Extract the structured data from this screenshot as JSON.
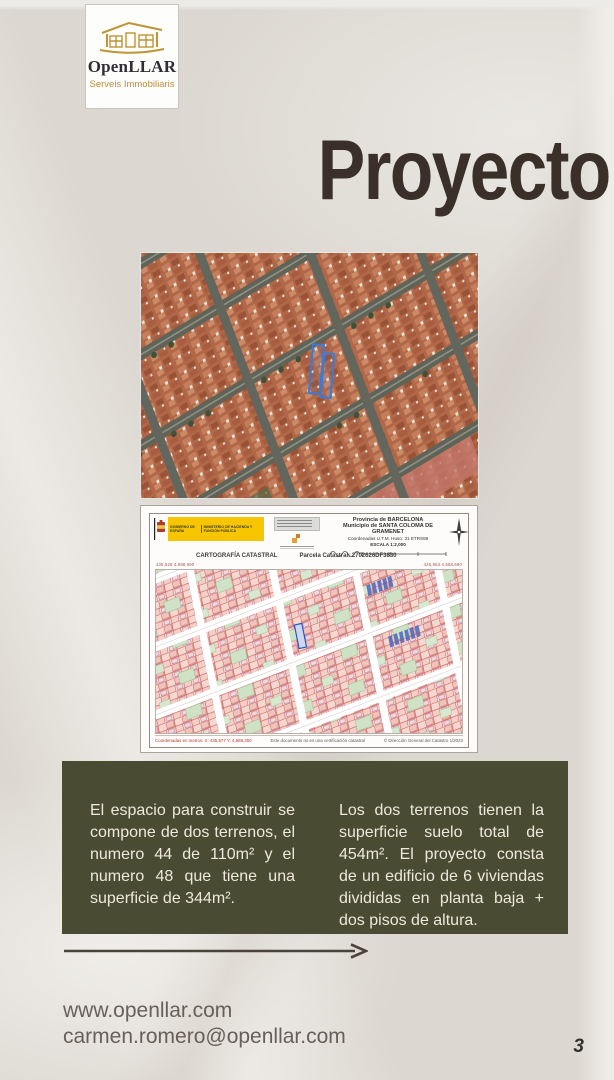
{
  "title": "Proyecto",
  "logo": {
    "name": "OpenLLAR",
    "tagline": "Serveis Immobiliaris",
    "house_icon": "gold-house-outline"
  },
  "colors": {
    "background": "#dcd8d1",
    "title_brown": "#3a3029",
    "accent_olive": "#494b32",
    "logo_gold": "#bf9434",
    "parcel_highlight_blue": "#3b7bd8",
    "map_parcel_pink": "#f6d8d2",
    "map_line_red": "#c4524a"
  },
  "aerial_photo": {
    "description": "satellite-view-of-urban-blocks-with-blue-outlined-parcel"
  },
  "cadastral": {
    "gov_logo": {
      "line_a": "GOBIERNO DE ESPAÑA",
      "line_b": "MINISTERIO DE HACIENDA Y FUNCIÓN PÚBLICA"
    },
    "meta": {
      "province": "Provincia de BARCELONA",
      "municipality": "Municipio de SANTA COLOMA DE GRAMENET",
      "coordinates": "Coordenadas U.T.M. Huso: 31 ETRS89",
      "scale": "ESCALA 1:2,000"
    },
    "subheader": {
      "left": "CARTOGRAFÍA CATASTRAL",
      "right": "Parcela Catastral: 2702626DF3830"
    },
    "corner_coords": {
      "top_left": "435,528  4,588,690",
      "top_right": "435,853  4,588,690",
      "bottom_left": "435,528  4,588,440",
      "bottom_right": "435,853  4,588,440"
    },
    "footer": {
      "left": "Coordenadas en metros: X: 435,577  Y: 4,588,350",
      "center": "Este documento no es una certificación catastral",
      "right": "© Dirección General del Catastro 1/2023"
    }
  },
  "info_box": {
    "left_paragraph": "El espacio para construir se compone de dos terrenos, el numero 44 de 110m² y el numero 48 que tiene una superficie de 344m².",
    "right_paragraph": "Los dos terrenos tienen la superficie suelo total de 454m². El proyecto consta de un edificio de 6 viviendas divididas en planta baja + dos pisos de altura."
  },
  "contact": {
    "website": "www.openllar.com",
    "email": "carmen.romero@openllar.com"
  },
  "page": {
    "number": "3"
  }
}
